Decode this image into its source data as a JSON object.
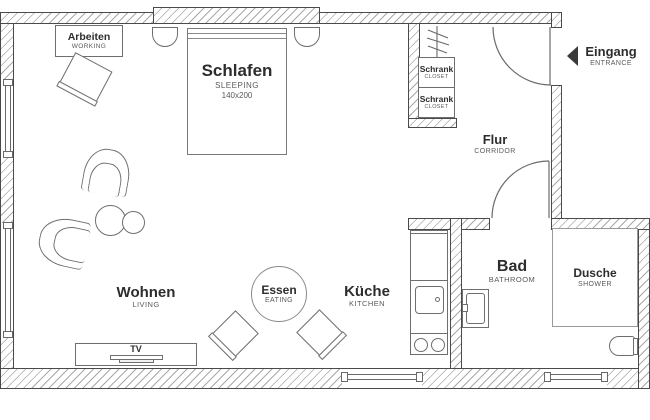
{
  "rooms": {
    "working": {
      "de": "Arbeiten",
      "en": "WORKING"
    },
    "sleeping": {
      "de": "Schlafen",
      "en": "SLEEPING",
      "size": "140x200"
    },
    "living": {
      "de": "Wohnen",
      "en": "LIVING"
    },
    "eating": {
      "de": "Essen",
      "en": "EATING"
    },
    "kitchen": {
      "de": "Küche",
      "en": "KITCHEN"
    },
    "bathroom": {
      "de": "Bad",
      "en": "BATHROOM"
    },
    "shower": {
      "de": "Dusche",
      "en": "SHOWER"
    },
    "corridor": {
      "de": "Flur",
      "en": "CORRIDOR"
    },
    "entrance": {
      "de": "Eingang",
      "en": "ENTRANCE"
    },
    "closet1": {
      "de": "Schrank",
      "en": "CLOSET"
    },
    "closet2": {
      "de": "Schrank",
      "en": "CLOSET"
    },
    "tv": {
      "label": "TV"
    }
  },
  "colors": {
    "wall_line": "#4a4a4a",
    "hatch": "#a8a8a8",
    "furniture_line": "#6e6e6e",
    "text_primary": "#2d2d2d",
    "text_secondary": "#5a5a5a"
  }
}
